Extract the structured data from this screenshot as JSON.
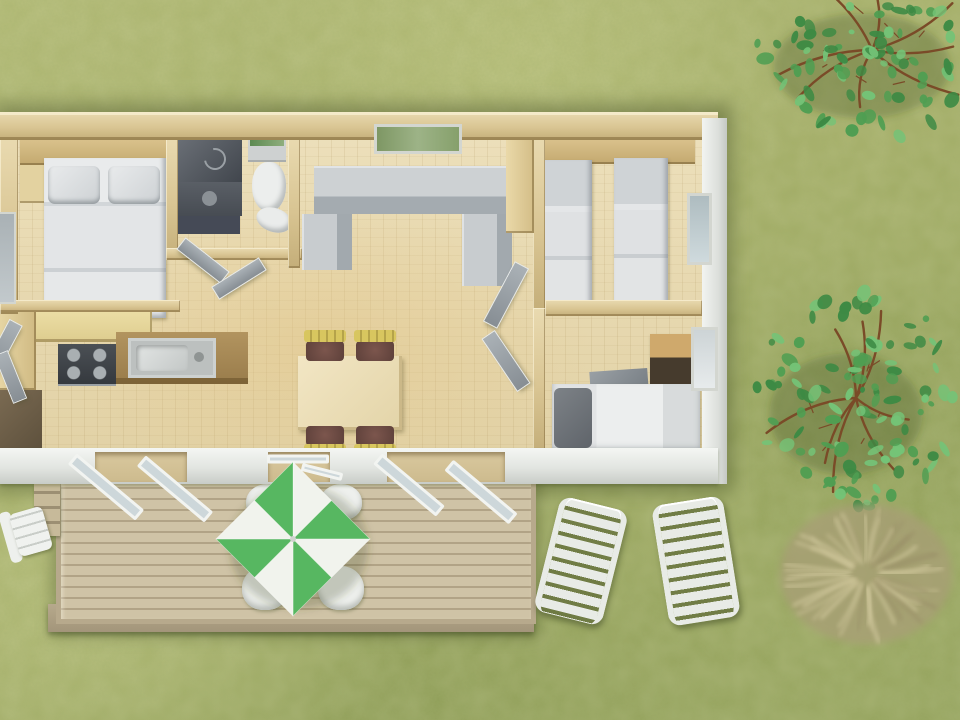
{
  "meta": {
    "description": "Aerial 3D rendering of a mobile-home floor plan with furnished rooms, a wooden deck with a green-and-white parasol, garden loungers and trees on a grass lawn",
    "visible_text": []
  },
  "palette": {
    "grass-light": "#b1b974",
    "grass-base": "#a3ad66",
    "grass-dark": "#93a25c",
    "wall": "#d9c593",
    "wall-hi": "#e9dab0",
    "wall-lo": "#c4ae79",
    "floor": "#ecdfba",
    "floor-warm": "#e2d2a6",
    "deck": "#cfc3a6",
    "deck-gap": "#b1a386",
    "deck-frame": "#b7a98c",
    "lounger": "#e8ebe6",
    "chair-yellow": "#d8c65f",
    "parasol-green": "#57b761",
    "parasol-white": "#f1f3ed",
    "glass": "#cdd7da",
    "door-frame-white": "#f2f4f1",
    "tree-leaf-dark": "#3d8a44",
    "tree-leaf-mid": "#4f9e52",
    "tree-leaf-light": "#74c377",
    "branch": "#7a4b28",
    "bush-base": "#a89e76",
    "bush-frond": "#d2c99e",
    "bush-frond-dark": "#9a9068"
  },
  "scene": {
    "house": {
      "rooms": [
        {
          "name": "double-bedroom",
          "furniture": [
            "double-bed",
            "pillows",
            "nightstand",
            "headboard-cabinet",
            "dresser"
          ]
        },
        {
          "name": "shower-room",
          "furniture": [
            "shower",
            "vanity-sink",
            "bath-mat"
          ]
        },
        {
          "name": "wc",
          "furniture": [
            "toilet",
            "cistern",
            "mirror",
            "hand-basin"
          ]
        },
        {
          "name": "kitchen",
          "furniture": [
            "gas-hob",
            "sink-counter",
            "cabinets"
          ]
        },
        {
          "name": "living-dining",
          "furniture": [
            "u-shaped-sofa",
            "dining-table",
            "4-chairs",
            "wardrobe"
          ]
        },
        {
          "name": "twin-bedroom",
          "furniture": [
            "single-bed",
            "single-bed",
            "headboard-cabinet"
          ]
        },
        {
          "name": "single-bedroom",
          "furniture": [
            "single-bed",
            "cabinet",
            "blanket"
          ]
        }
      ],
      "windows": 5,
      "open_doors": 6
    },
    "deck": {
      "chairs": 4,
      "steps": 1
    },
    "parasol": {
      "cx": 293,
      "cy": 539,
      "r": 77,
      "segments": 8
    },
    "door_panels": [
      {
        "cx": 106,
        "cy": 487,
        "w": 88,
        "h": 14,
        "deg": 40
      },
      {
        "cx": 175,
        "cy": 489,
        "w": 88,
        "h": 14,
        "deg": 40
      },
      {
        "cx": 409,
        "cy": 485,
        "w": 82,
        "h": 14,
        "deg": 40
      },
      {
        "cx": 481,
        "cy": 492,
        "w": 84,
        "h": 14,
        "deg": 40
      }
    ],
    "lintels": [
      {
        "cx": 298,
        "cy": 459,
        "w": 62,
        "h": 9,
        "deg": 0
      },
      {
        "cx": 322,
        "cy": 472,
        "w": 42,
        "h": 8,
        "deg": 14
      }
    ],
    "trees": [
      {
        "cx": 872,
        "cy": 50,
        "rx": 118,
        "ry": 95,
        "leaves": 90,
        "branches": 8,
        "seed": 3
      },
      {
        "cx": 856,
        "cy": 398,
        "rx": 102,
        "ry": 110,
        "leaves": 110,
        "branches": 8,
        "seed": 9
      }
    ],
    "bush": {
      "cx": 866,
      "cy": 574,
      "rx": 86,
      "ry": 70,
      "fronds": 46,
      "seed": 5
    },
    "loungers": 2,
    "garden_chairs": 1
  }
}
